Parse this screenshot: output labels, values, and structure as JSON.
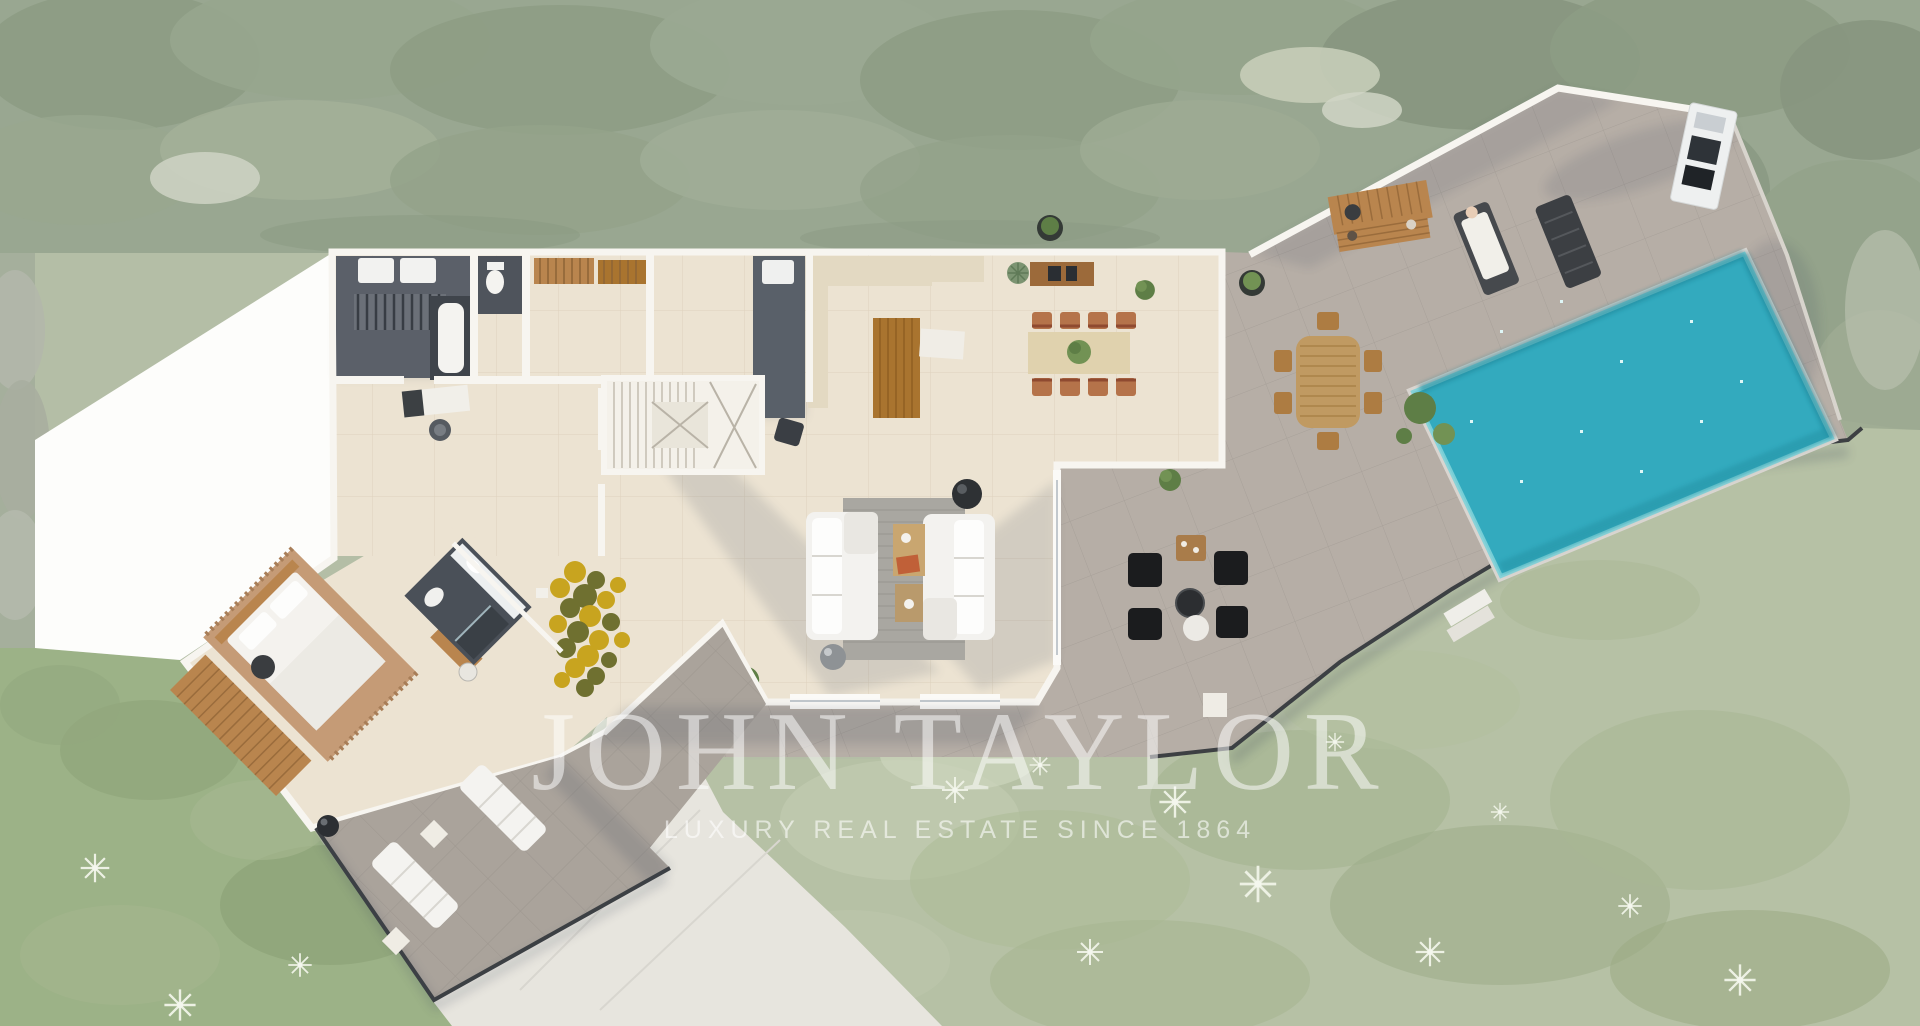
{
  "watermark": {
    "brand": "JOHN TAYLOR",
    "tagline": "LUXURY REAL ESTATE SINCE 1864"
  },
  "scene": {
    "description": "Top-down aerial 3D rendering of a luxury villa floor plan with swimming pool, terraces, garden and driveway"
  },
  "colors": {
    "foliage": "#99a791",
    "foliage_dark": "#87977f",
    "foliage_light": "#b6c0aa",
    "grass": "#9cb287",
    "garden": "#b6c1a5",
    "garden_light": "#c9d1b9",
    "terrace": "#b6aea6",
    "walkway": "#aaa39b",
    "interior": "#ece3d2",
    "interior_tile": "#e3d9c2",
    "wall": "#f7f5f0",
    "dark_room": "#5b6069",
    "pool_water": "#33aabe",
    "pool_edge": "#7ed2d8",
    "pool_coping": "#d9d5d0",
    "wood": "#b9854e",
    "wood_dark": "#a9742f",
    "rug_gray": "#a9a7a1",
    "rug_brown": "#c59b76",
    "rug_gold": "#c8a41f",
    "rug_olive": "#6f7030",
    "sofa": "#f3f2ef",
    "black_furniture": "#1b1c1e",
    "terracotta": "#b5734a",
    "driveway": "#e7e5de",
    "white_area": "#fdfdfb",
    "deck_rail": "#3d4043"
  }
}
